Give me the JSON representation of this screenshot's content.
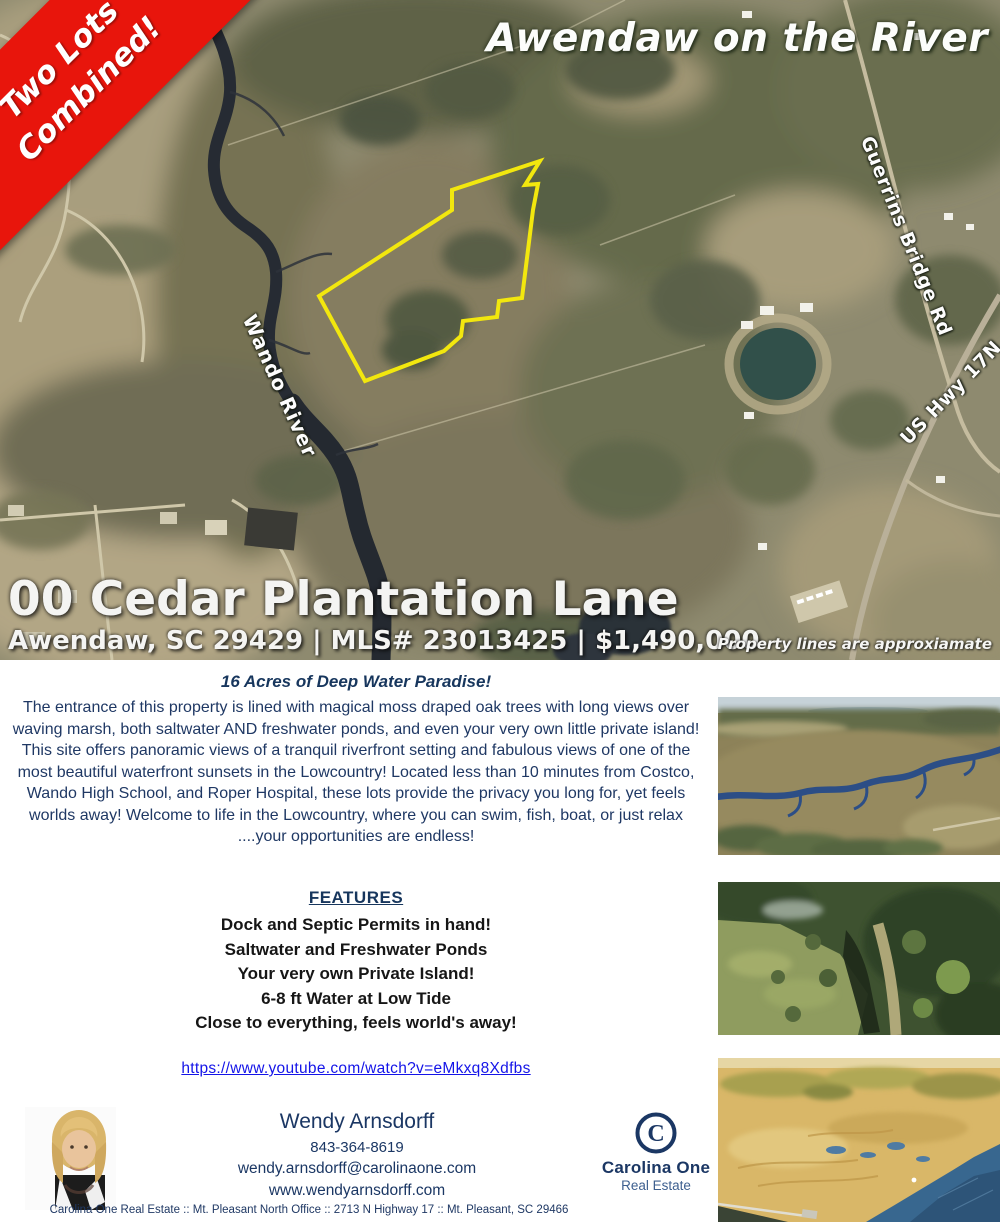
{
  "banner": {
    "line1": "Two Lots",
    "line2": "Combined!"
  },
  "map": {
    "title": "Awendaw on the River",
    "labels": {
      "river": "Wando River",
      "road1": "Guerrins Bridge Rd",
      "road2": "US Hwy 17N"
    },
    "address_line1": "00 Cedar Plantation Lane",
    "address_line2": "Awendaw, SC 29429 | MLS# 23013425 | $1,490,000",
    "disclaimer": "Property lines are approxiamate"
  },
  "body": {
    "headline": "16 Acres of Deep Water Paradise!",
    "paragraph": "The entrance of this property is lined with magical moss draped oak trees with long views over waving marsh, both saltwater AND freshwater ponds, and even your very own little private island! This site offers panoramic views of a tranquil riverfront setting and fabulous views of one of the most beautiful waterfront sunsets in the Lowcountry! Located less than 10 minutes from Costco, Wando High School, and Roper Hospital, these lots provide the privacy you long for, yet feels worlds away! Welcome to life in the Lowcountry, where you can swim, fish, boat, or just relax ....your opportunities are endless!",
    "features_title": "FEATURES",
    "features": [
      "Dock and Septic Permits in hand!",
      "Saltwater and Freshwater Ponds",
      "Your very own Private Island!",
      "6-8 ft Water at Low Tide",
      "Close to everything, feels world's away!"
    ],
    "video_link": "https://www.youtube.com/watch?v=eMkxq8Xdfbs"
  },
  "agent": {
    "name": "Wendy Arnsdorff",
    "phone": "843-364-8619",
    "email": "wendy.arnsdorff@carolinaone.com",
    "website": "www.wendyarnsdorff.com"
  },
  "brand": {
    "symbol": "C",
    "name": "Carolina One",
    "sub": "Real Estate"
  },
  "footer": "Carolina One Real Estate :: Mt. Pleasant North Office :: 2713 N Highway 17 :: Mt. Pleasant, SC 29466",
  "colors": {
    "banner_red": "#e8150c",
    "navy": "#1f3864",
    "link_blue": "#1414e8",
    "boundary_yellow": "#f2e70e"
  }
}
